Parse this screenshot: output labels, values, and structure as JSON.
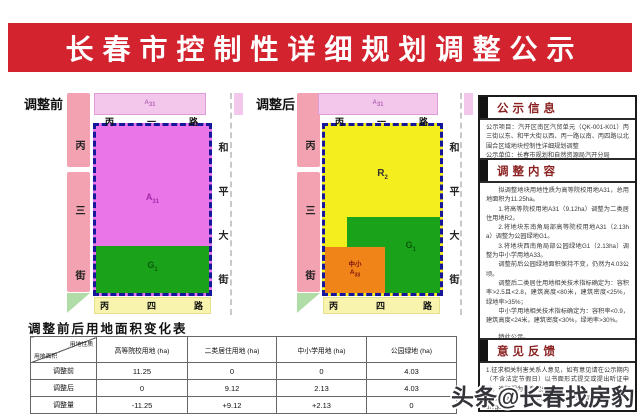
{
  "banner": {
    "title": "长春市控制性详细规划调整公示"
  },
  "colors": {
    "banner_red": "#d2232e",
    "parcel_magenta": "#ea75e8",
    "parcel_light_pink": "#f3c6ec",
    "road_strip_pink": "#f2a2b0",
    "parcel_green": "#1aa21a",
    "parcel_yellow": "#f4ee1e",
    "parcel_orange": "#f08418",
    "road_strip_yellow": "#f8f4ad",
    "boundary_navy": "#16169c"
  },
  "map_before": {
    "label": "调整前",
    "street_left": "丙三街",
    "road_top": "丙一路",
    "street_right": "和平大街",
    "road_bottom": "丙四路",
    "north_parcel": {
      "base": "A",
      "sub": "31"
    },
    "main_parcel": {
      "base": "A",
      "sub": "31"
    },
    "green_parcel": {
      "base": "G",
      "sub": "1"
    }
  },
  "map_after": {
    "label": "调整后",
    "street_left": "丙三街",
    "road_top": "丙一路",
    "street_right": "和平大街",
    "road_bottom": "丙四路",
    "north_parcel": {
      "base": "A",
      "sub": "31"
    },
    "main_parcel": {
      "base": "R",
      "sub": "2"
    },
    "green_parcel": {
      "base": "G",
      "sub": "1"
    },
    "school_parcel": {
      "line1": "中小",
      "base": "A",
      "sub": "33"
    }
  },
  "panel": {
    "sections": [
      {
        "title": "公示信息",
        "paragraphs": [
          "公示项目：汽开区南区汽贸单元（QK-001-K01）丙三街以东、和平大街以西、丙一路以南、丙四路以北围合区域地块控制性详细规划调整",
          "公示单位：长春市规划和自然资源局汽开分局",
          "公示时间：自2021年8月17日起，不少于30天"
        ]
      },
      {
        "title": "调整内容",
        "paragraphs": [
          "拟调整地块用地性质为高等院校用地A31，总用地面积为11.25ha。",
          "1.将高等院校用地A31（9.12ha）调整为二类居住用地R2。",
          "2.将地块东南角局部高等院校用地A31（2.13ha）调整为公园绿地G1。",
          "3.将地块西南角局部公园绿地G1（2.13ha）调整为中小学用地A33。",
          "调整前后公园绿地面积保持不变，仍然为4.03公顷。",
          "调整后二类居住用地相关技术指标确定为：容积率>2.5且<2.8，建筑高度<80米，建筑密度<25%，绿地率>35%；",
          "中小学用地相关技术指标确定为：容积率<0.9，建筑高度<24米，建筑密度<30%，绿地率>30%。",
          "特此公示。"
        ]
      },
      {
        "title": "意见反馈",
        "paragraphs": [
          "1.征求相关利害关系人意见，如有意见请在公示期内（不含法定节假日）以书面形式提交或提出听证申请，逾期视为无意见处理。",
          "2.网上查询：长春市规划和自然资源局（grj.changchun.gov.cn）",
          "3.联系……"
        ]
      }
    ]
  },
  "table": {
    "title": "调整前后用地面积变化表",
    "corner": {
      "top_right": "用地性质",
      "bottom_left": "用地面积"
    },
    "columns": [
      "高等院校用地 (ha)",
      "二类居住用地 (ha)",
      "中小学用地 (ha)",
      "公园绿地 (ha)"
    ],
    "rows": [
      {
        "label": "调整前",
        "cells": [
          "11.25",
          "0",
          "0",
          "4.03"
        ]
      },
      {
        "label": "调整后",
        "cells": [
          "0",
          "9.12",
          "2.13",
          "4.03"
        ]
      },
      {
        "label": "调整量",
        "cells": [
          "-11.25",
          "+9.12",
          "+2.13",
          "0"
        ]
      }
    ]
  },
  "watermark": "头条@长春找房豹"
}
